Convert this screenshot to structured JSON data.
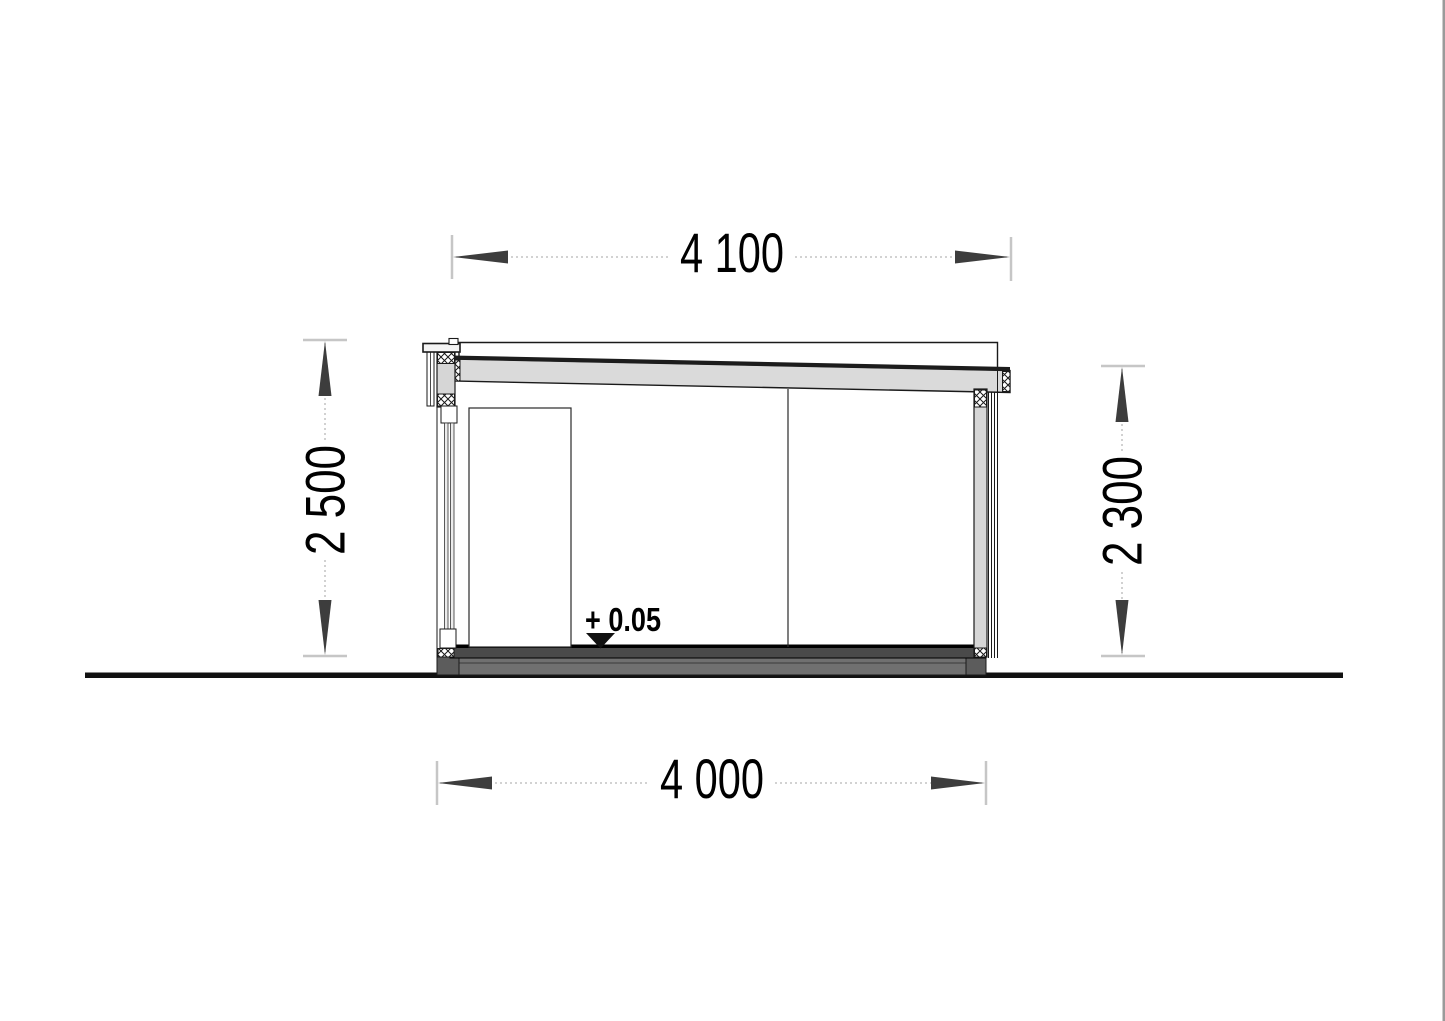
{
  "drawing": {
    "title": "cabin-side-elevation-section",
    "dims": {
      "roof_width": "4 100",
      "wall_height_left": "2 500",
      "wall_height_right": "2 300",
      "base_width": "4 000"
    },
    "level": "+ 0.05"
  },
  "colors": {
    "outline": "#1a1a1a",
    "beam_fill": "#dadada",
    "roof_strip": "#1c1c1c",
    "post_fill": "#d6d6d6",
    "trim_fill": "#f4f4f4",
    "glass_fill": "#ececec",
    "door_fill": "#ffffff",
    "floor_fill": "#4a4a4a",
    "floor_edge": "#000000",
    "foundation_fill": "#707070",
    "foundation_block_fill": "#5c5c5c",
    "ground": "#111111",
    "dim_line": "#b8b8b8",
    "dim_tick": "#c6c6c6",
    "dim_arrow": "#3d3d3d",
    "level_marker": "#111111",
    "page_edge": "#9a9a9a"
  }
}
